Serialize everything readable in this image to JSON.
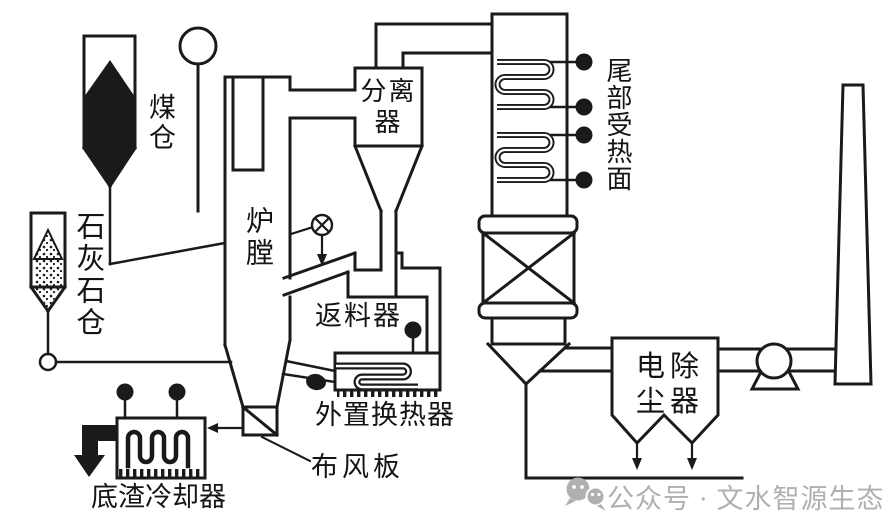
{
  "labels": {
    "coal_bunker": "煤仓",
    "limestone_bunker": "石灰石仓",
    "furnace": "炉膛",
    "separator": {
      "line1": "分离",
      "line2": "器"
    },
    "return_feeder": "返料器",
    "external_heat_exchanger": "外置换热器",
    "air_distribution_plate": "布风板",
    "bottom_slag_cooler": "底渣冷却器",
    "tail_heating_surface": "尾部受热面",
    "esp": {
      "line1": "电除",
      "line2": "尘器"
    }
  },
  "watermark": {
    "text": "公众号 · 文水智源生态",
    "color": "#b0b0b0"
  },
  "colors": {
    "line": "#1a1a1a",
    "background": "#ffffff"
  }
}
